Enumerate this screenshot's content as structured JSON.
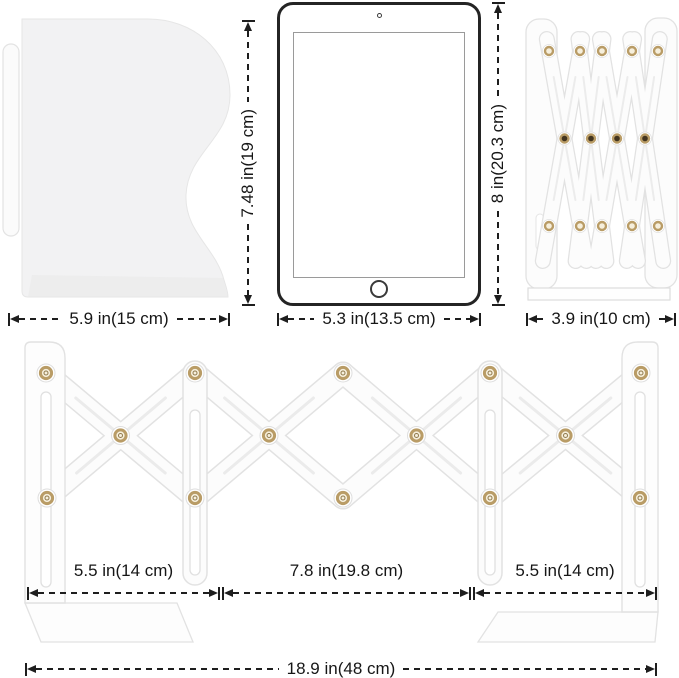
{
  "diagram": {
    "kind": "expandable-bookend-dimension-diagram",
    "colors": {
      "background": "#ffffff",
      "dimension_line": "#1e1e1e",
      "metal_white": "#fcfcfc",
      "metal_outline": "#e2e2e2",
      "bookend_panel_fill": "#f2f2f3",
      "rivet_gold": "#b99c66",
      "rivet_center_cream": "#f6efdc",
      "rivet_center_dark": "#42341f",
      "tablet_border": "#242424"
    }
  },
  "side_bookend": {
    "width_label": "5.9 in(15 cm)",
    "height_label": "7.48 in(19 cm)"
  },
  "tablet": {
    "width_label": "5.3 in(13.5 cm)",
    "height_label": "8 in(20.3 cm)"
  },
  "folded_bookend": {
    "width_label": "3.9 in(10 cm)"
  },
  "expanded_bookend": {
    "left_width_label": "5.5 in(14 cm)",
    "middle_width_label": "7.8 in(19.8 cm)",
    "right_width_label": "5.5 in(14 cm)",
    "total_width_label": "18.9 in(48 cm)"
  }
}
